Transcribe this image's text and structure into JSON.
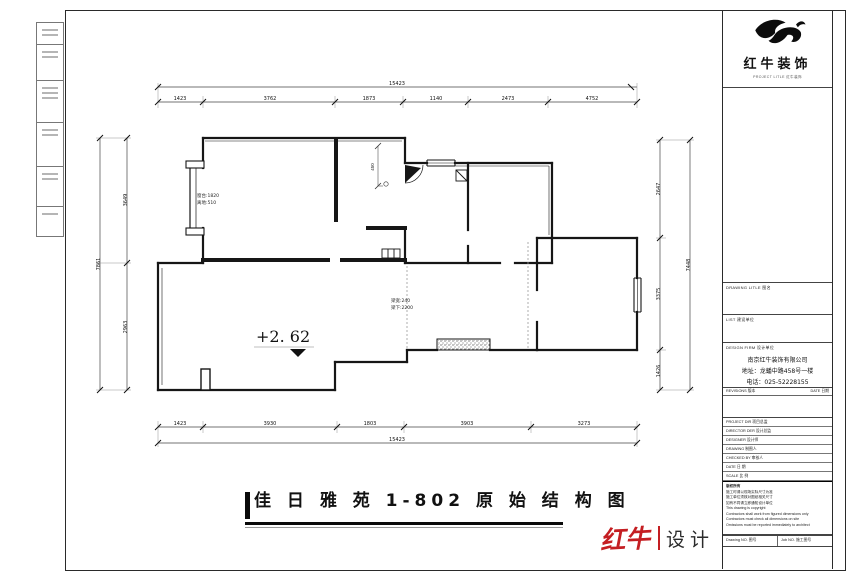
{
  "drawing": {
    "title": "佳 日 雅 苑 1-802 原 始 结 构 图",
    "level_marker": "+2. 62",
    "beam_note_line1": "梁宽:240",
    "beam_note_line2": "梁下:2200",
    "window_note_line1": "窗台:1820",
    "window_note_line2": "离地:510",
    "corridor_dim": "450"
  },
  "dims": {
    "top_overall": "15423",
    "top": [
      "1423",
      "3762",
      "1873",
      "1140",
      "2473",
      "4752"
    ],
    "bottom": [
      "1423",
      "3930",
      "1803",
      "3903",
      "3273"
    ],
    "bottom_overall": "15423",
    "left": [
      "3649",
      "2963"
    ],
    "left_overall": "7861",
    "right": [
      "2647",
      "3375",
      "1426"
    ],
    "right_overall": "7448"
  },
  "title_block": {
    "logo_name": "红牛装饰",
    "logo_caption": "PROJECT LITLE 红牛装饰",
    "drawing_title_label": "DRAWING LITLE 图名",
    "list_label": "LIST 建设单位",
    "design_firm_label": "DESIGN FIRM 设计单位",
    "company_name": "南京红牛装饰有限公司",
    "company_address": "地址：龙蟠中路458号一楼",
    "company_phone": "电话：025-52228155",
    "revisions_label": "REVISIONS 版本",
    "date_label": "DATE 日期",
    "personnel_rows": [
      {
        "label": "PROJECT DIR 项目总监",
        "value": ""
      },
      {
        "label": "DIRECTOR DER 设计总监",
        "value": ""
      },
      {
        "label": "DESIGNER 设计师",
        "value": ""
      },
      {
        "label": "DRAWING 制图人",
        "value": ""
      },
      {
        "label": "CHECKED BY 审核人",
        "value": ""
      },
      {
        "label": "DATE 日 期",
        "value": ""
      },
      {
        "label": "SCALE 比 例",
        "value": ""
      }
    ],
    "notes": [
      "版权所有",
      "施工时请以现场实际尺寸为准",
      "施工单位须核对图纸相关尺寸",
      "如有不同请立即通知设计单位",
      "This drawing is copyright",
      "Contractors shall work from figured dimensions only",
      "Contractors must check all dimensions on site",
      "Omissions must be reported immediately to architect"
    ],
    "drawing_no_label": "Drawing NO. 图号",
    "job_no_label": "Job NO. 施工图号"
  },
  "footer_logo": {
    "brand": "红牛",
    "suffix": "设计",
    "color": "#c41e22"
  }
}
